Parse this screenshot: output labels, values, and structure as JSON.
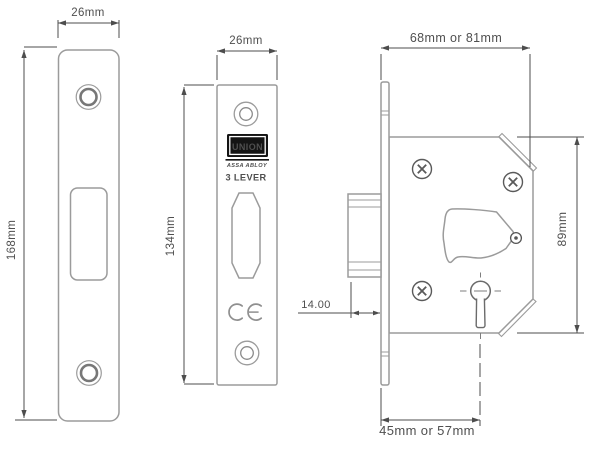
{
  "diagram": {
    "views": {
      "faceplate": {
        "width_label": "26mm",
        "height_label": "168mm"
      },
      "lock_front": {
        "width_label": "26mm",
        "height_label": "134mm",
        "logo": "UNION",
        "brand": "ASSA ABLOY",
        "lever": "3 LEVER"
      },
      "lock_side": {
        "depth_label": "68mm or 81mm",
        "height_label": "89mm",
        "backset_label": "45mm or 57mm",
        "bolt_throw_label": "14.00"
      }
    },
    "colors": {
      "outline": "#9b9b9b",
      "dimension": "#4d4d4d",
      "logo_background": "#141414",
      "logo_text": "#ffffff"
    }
  }
}
